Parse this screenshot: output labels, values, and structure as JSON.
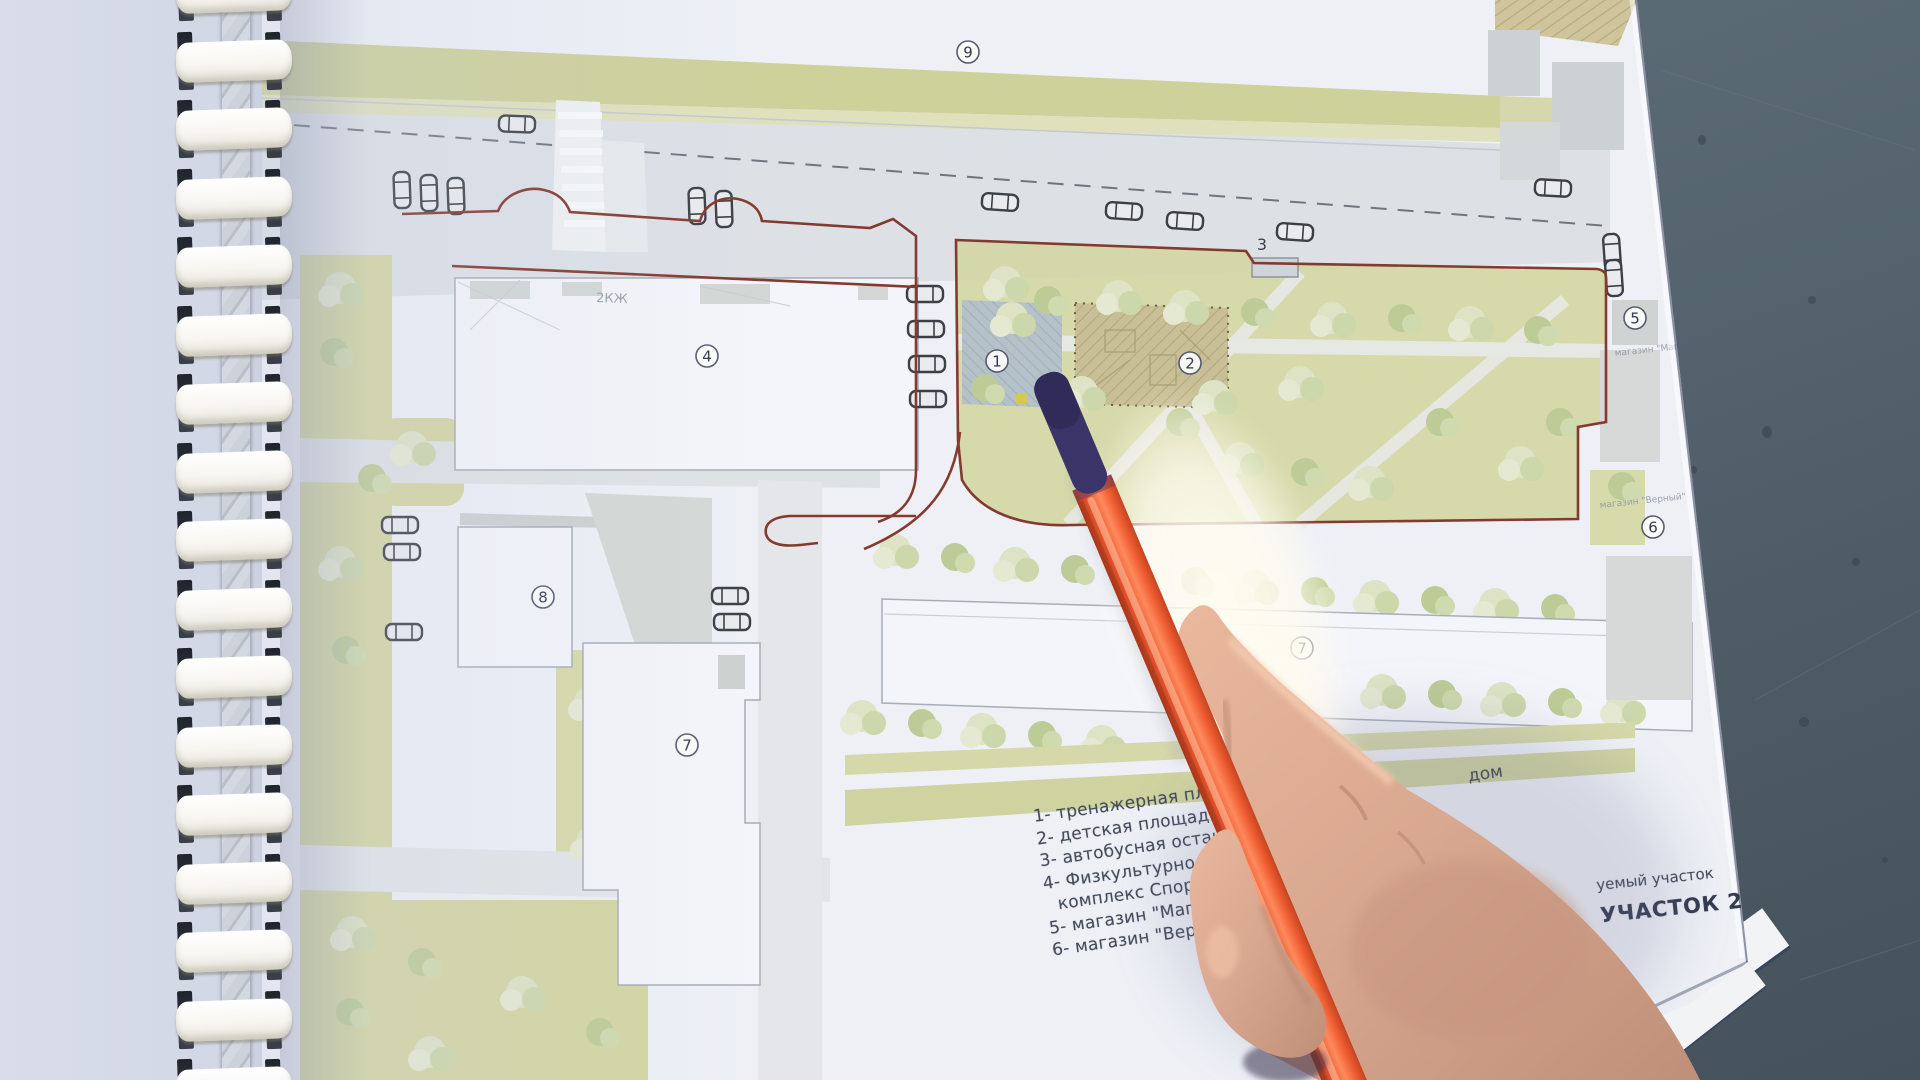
{
  "map": {
    "markers": {
      "m1": "1",
      "m2": "2",
      "m4": "4",
      "m5": "5",
      "m6": "6",
      "m7": "7",
      "m8": "8",
      "m9": "9"
    },
    "bus_stop_label": "3",
    "building_code": "2КЖ",
    "shop5_label": "магазин \"Магнит\"",
    "shop6_label": "магазин \"Верный\"",
    "legend": [
      "1- тренажерная площадка",
      "2- детская площадка",
      "3- автобусная остановка",
      "4- Физкультурно-оздоровит",
      "комплекс Спортивная н",
      "5- магазин \"Магнит\"",
      "6- магазин \"Вер"
    ],
    "legend_right": {
      "item7_num": "7-",
      "item7_end": "дом",
      "site_note": "уемый участок",
      "site_title": "УЧАСТОК 2"
    }
  },
  "colors": {
    "page": "#eef0f6",
    "left_page": "#d5dae7",
    "concrete": "#5a6a75",
    "concrete_dark": "#45525c",
    "green_band": "#cdd19a",
    "park_green": "#d3d6a2",
    "tree": "#dde3c4",
    "road": "#dde1e6",
    "building": "#f4f5fa",
    "building_border": "#a7adb6",
    "boundary_red": "#833a2f",
    "area1_gray": "#b5c1c8",
    "area2_tan": "#c9bf97",
    "pen_orange": "#e8552e",
    "pen_tip": "#3a3468",
    "skin": "#d8a78f"
  }
}
